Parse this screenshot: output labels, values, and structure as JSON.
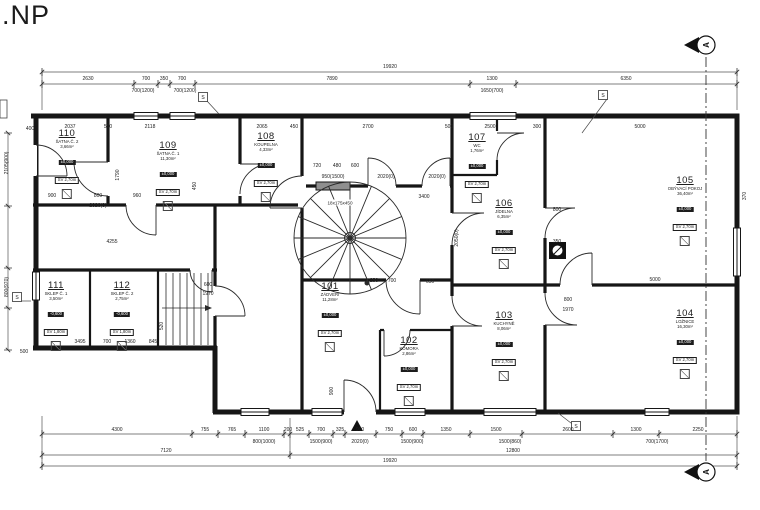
{
  "title": ".NP",
  "section": {
    "label": "A"
  },
  "stair": {
    "label": "18x175x450"
  },
  "wall_markers": {
    "label": "S",
    "positions": [
      {
        "x": 203,
        "y": 97,
        "lx": 219,
        "ly": 114
      },
      {
        "x": 603,
        "y": 95,
        "lx": 582,
        "ly": 133
      },
      {
        "x": 17,
        "y": 297,
        "lx": 31,
        "ly": 301
      },
      {
        "x": 576,
        "y": 426,
        "lx": 558,
        "ly": 413
      }
    ]
  },
  "rooms": [
    {
      "id": "101",
      "name": "ZÁDVEŘÍ",
      "area": "11,28m²",
      "level": "±0,000",
      "height": "SV 2,70m",
      "x": 330,
      "y": 282
    },
    {
      "id": "102",
      "name": "KOMORA",
      "area": "2,86m²",
      "level": "±0,000",
      "height": "SV 2,70m",
      "x": 409,
      "y": 336
    },
    {
      "id": "103",
      "name": "KUCHYNĚ",
      "area": "8,06m²",
      "level": "±0,000",
      "height": "SV 2,70m",
      "x": 504,
      "y": 311
    },
    {
      "id": "104",
      "name": "LOŽNICE",
      "area": "16,30m²",
      "level": "±0,000",
      "height": "SV 2,70m",
      "x": 685,
      "y": 309
    },
    {
      "id": "105",
      "name": "OBÝVACÍ POKOJ",
      "area": "36,40m²",
      "level": "±0,000",
      "height": "SV 2,70m",
      "x": 685,
      "y": 176
    },
    {
      "id": "106",
      "name": "JÍDELNA",
      "area": "6,35m²",
      "level": "±0,000",
      "height": "SV 2,70m",
      "x": 504,
      "y": 199
    },
    {
      "id": "107",
      "name": "WC",
      "area": "1,76m²",
      "level": "±0,000",
      "height": "SV 2,70m",
      "x": 477,
      "y": 133
    },
    {
      "id": "108",
      "name": "KOUPELNA",
      "area": "4,33m²",
      "level": "±0,000",
      "height": "SV 2,70m",
      "x": 266,
      "y": 132
    },
    {
      "id": "109",
      "name": "ŠATNA Č. 1",
      "area": "11,30m²",
      "level": "±0,000",
      "height": "SV 2,70m",
      "x": 168,
      "y": 141
    },
    {
      "id": "110",
      "name": "ŠATNA Č. 2",
      "area": "3,66m²",
      "level": "±0,000",
      "height": "SV 2,70m",
      "x": 67,
      "y": 129
    },
    {
      "id": "111",
      "name": "SKLEP Č. 1",
      "area": "3,50m²",
      "level": "-0,600",
      "height": "SV 1,80m",
      "x": 56,
      "y": 281
    },
    {
      "id": "112",
      "name": "SKLEP Č. 2",
      "area": "2,75m²",
      "level": "-0,600",
      "height": "SV 1,80m",
      "x": 122,
      "y": 281
    }
  ],
  "dims": [
    {
      "t": "19920",
      "x": 390,
      "y": 68
    },
    {
      "t": "2630",
      "x": 88,
      "y": 80
    },
    {
      "t": "700",
      "x": 146,
      "y": 80
    },
    {
      "t": "350",
      "x": 164,
      "y": 80
    },
    {
      "t": "700",
      "x": 182,
      "y": 80
    },
    {
      "t": "7890",
      "x": 332,
      "y": 80
    },
    {
      "t": "1300",
      "x": 492,
      "y": 80
    },
    {
      "t": "6350",
      "x": 626,
      "y": 80
    },
    {
      "t": "700(1200)",
      "x": 143,
      "y": 92
    },
    {
      "t": "700(1200)",
      "x": 185,
      "y": 92
    },
    {
      "t": "1650(700)",
      "x": 492,
      "y": 92
    },
    {
      "t": "400",
      "x": 30,
      "y": 130
    },
    {
      "t": "2037",
      "x": 70,
      "y": 128
    },
    {
      "t": "500",
      "x": 108,
      "y": 128
    },
    {
      "t": "2118",
      "x": 150,
      "y": 128
    },
    {
      "t": "2065",
      "x": 262,
      "y": 128
    },
    {
      "t": "450",
      "x": 294,
      "y": 128
    },
    {
      "t": "2700",
      "x": 368,
      "y": 128
    },
    {
      "t": "500",
      "x": 449,
      "y": 128
    },
    {
      "t": "2500",
      "x": 490,
      "y": 128
    },
    {
      "t": "300",
      "x": 537,
      "y": 128
    },
    {
      "t": "5000",
      "x": 640,
      "y": 128
    },
    {
      "t": "720",
      "x": 317,
      "y": 167
    },
    {
      "t": "480",
      "x": 337,
      "y": 167
    },
    {
      "t": "600",
      "x": 355,
      "y": 167
    },
    {
      "t": "950(1500)",
      "x": 333,
      "y": 178
    },
    {
      "t": "2020(0)",
      "x": 386,
      "y": 178
    },
    {
      "t": "2020(0)",
      "x": 437,
      "y": 178
    },
    {
      "t": "900",
      "x": 52,
      "y": 197
    },
    {
      "t": "800",
      "x": 98,
      "y": 197
    },
    {
      "t": "960",
      "x": 137,
      "y": 197
    },
    {
      "t": "2020(0)",
      "x": 98,
      "y": 207
    },
    {
      "t": "4255",
      "x": 112,
      "y": 243
    },
    {
      "t": "1790",
      "x": 119,
      "y": 175,
      "r": 1
    },
    {
      "t": "450",
      "x": 196,
      "y": 186,
      "r": 1
    },
    {
      "t": "3400",
      "x": 424,
      "y": 198
    },
    {
      "t": "800",
      "x": 557,
      "y": 211
    },
    {
      "t": "350",
      "x": 557,
      "y": 243
    },
    {
      "t": "5000",
      "x": 655,
      "y": 281
    },
    {
      "t": "800",
      "x": 568,
      "y": 301
    },
    {
      "t": "1970",
      "x": 568,
      "y": 311
    },
    {
      "t": "600",
      "x": 208,
      "y": 286
    },
    {
      "t": "1970",
      "x": 208,
      "y": 295
    },
    {
      "t": "650",
      "x": 430,
      "y": 283
    },
    {
      "t": "250",
      "x": 374,
      "y": 282
    },
    {
      "t": "700",
      "x": 392,
      "y": 282
    },
    {
      "t": "2050(0)",
      "x": 458,
      "y": 238,
      "r": 1
    },
    {
      "t": "370",
      "x": 746,
      "y": 196,
      "r": 1
    },
    {
      "t": "900",
      "x": 333,
      "y": 391,
      "r": 1
    },
    {
      "t": "520",
      "x": 163,
      "y": 326,
      "r": 1
    },
    {
      "t": "3495",
      "x": 80,
      "y": 343
    },
    {
      "t": "700",
      "x": 107,
      "y": 343
    },
    {
      "t": "1360",
      "x": 130,
      "y": 343
    },
    {
      "t": "845",
      "x": 153,
      "y": 343
    },
    {
      "t": "500",
      "x": 24,
      "y": 353
    },
    {
      "t": "2105(900)",
      "x": 8,
      "y": 163,
      "r": 1
    },
    {
      "t": "800(970)",
      "x": 8,
      "y": 287,
      "r": 1
    },
    {
      "t": "4300",
      "x": 117,
      "y": 431
    },
    {
      "t": "755",
      "x": 205,
      "y": 431
    },
    {
      "t": "765",
      "x": 232,
      "y": 431
    },
    {
      "t": "1100",
      "x": 264,
      "y": 431
    },
    {
      "t": "200",
      "x": 288,
      "y": 431
    },
    {
      "t": "525",
      "x": 300,
      "y": 431
    },
    {
      "t": "700",
      "x": 321,
      "y": 431
    },
    {
      "t": "325",
      "x": 340,
      "y": 431
    },
    {
      "t": "900",
      "x": 360,
      "y": 431
    },
    {
      "t": "750",
      "x": 389,
      "y": 431
    },
    {
      "t": "600",
      "x": 413,
      "y": 431
    },
    {
      "t": "1350",
      "x": 446,
      "y": 431
    },
    {
      "t": "1500",
      "x": 496,
      "y": 431
    },
    {
      "t": "2600",
      "x": 568,
      "y": 431
    },
    {
      "t": "1300",
      "x": 636,
      "y": 431
    },
    {
      "t": "2250",
      "x": 698,
      "y": 431
    },
    {
      "t": "800(1000)",
      "x": 264,
      "y": 443
    },
    {
      "t": "1500(900)",
      "x": 321,
      "y": 443
    },
    {
      "t": "2020(0)",
      "x": 360,
      "y": 443
    },
    {
      "t": "1500(900)",
      "x": 412,
      "y": 443
    },
    {
      "t": "1500(860)",
      "x": 510,
      "y": 443
    },
    {
      "t": "700(1700)",
      "x": 657,
      "y": 443
    },
    {
      "t": "7120",
      "x": 166,
      "y": 452
    },
    {
      "t": "12800",
      "x": 513,
      "y": 452
    },
    {
      "t": "19920",
      "x": 390,
      "y": 462
    }
  ]
}
